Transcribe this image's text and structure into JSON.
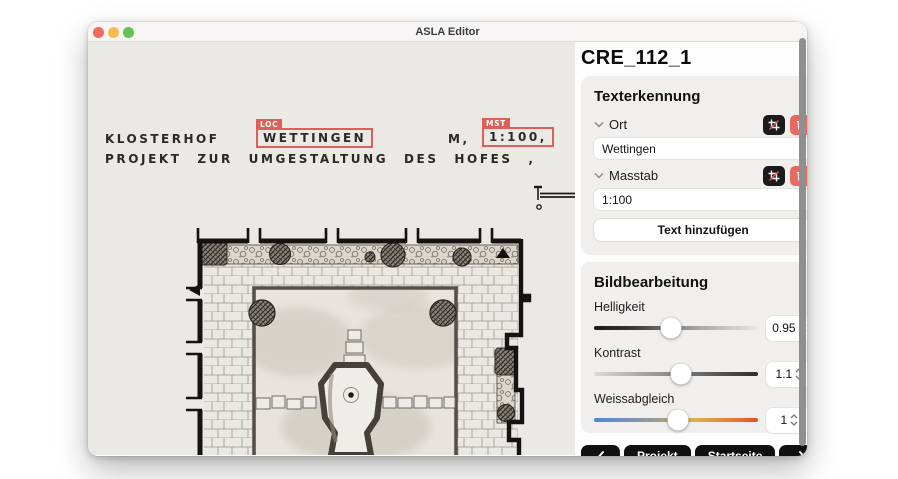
{
  "titlebar": {
    "title": "ASLA Editor"
  },
  "panel": {
    "title": "CRE_112_1",
    "text_recognition": {
      "heading": "Texterkennung",
      "fields": [
        {
          "label": "Ort",
          "value": "Wettingen"
        },
        {
          "label": "Masstab",
          "value": "1:100"
        }
      ],
      "add_button_label": "Text hinzufügen"
    },
    "image_editing": {
      "heading": "Bildbearbeitung",
      "sliders": [
        {
          "label": "Helligkeit",
          "value": "0.95",
          "percent": 47
        },
        {
          "label": "Kontrast",
          "value": "1.1",
          "percent": 53
        },
        {
          "label": "Weissabgleich",
          "value": "1",
          "percent": 51
        }
      ]
    },
    "nav": {
      "projekt_label": "Projekt",
      "startseite_label": "Startseite"
    }
  },
  "document": {
    "line1_word": "KLOSTERHOF",
    "loc": {
      "tag": "LOC",
      "text": "WETTINGEN"
    },
    "m_label": "M,",
    "mst": {
      "tag": "MST",
      "text": "1:100,"
    },
    "line2": "PROJEKT ZUR UMGESTALTUNG DES HOFES ,"
  },
  "icons": {
    "traffic_lights": [
      "close-icon",
      "minimize-icon",
      "zoom-icon"
    ],
    "field_chevron": "chevron-down-icon",
    "field_actions": [
      "crop-icon",
      "trash-icon"
    ],
    "value_stepper": "stepper-icon",
    "nav_arrows": [
      "chevron-left-icon",
      "chevron-right-icon"
    ]
  },
  "colors": {
    "annotation_red": "#dd5f58",
    "delete_red": "#e66a62",
    "button_black": "#101010",
    "traffic": [
      "#ee6a5e",
      "#f5bd4f",
      "#61c454"
    ],
    "paper": "#ebe9e4"
  }
}
